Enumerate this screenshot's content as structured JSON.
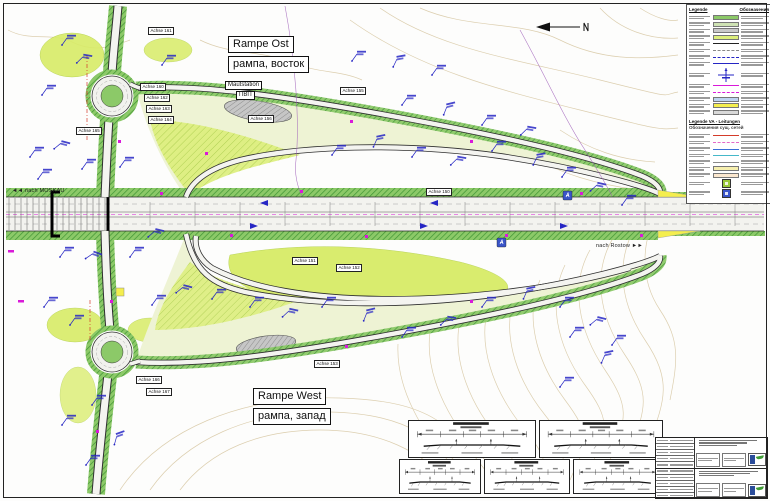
{
  "plan": {
    "rampe_ost_de": "Rampe Ost",
    "rampe_ost_ru": "рампа, восток",
    "rampe_west_de": "Rampe West",
    "rampe_west_ru": "рампа, запад",
    "mautstation_de": "Mautstation",
    "mautstation_ru": "ПВП",
    "nach_moskau": "◄◄ nach MOSKAU",
    "nach_rostow": "nach Rostow ►►"
  },
  "axes": [
    {
      "label": "Achse 161",
      "x": 148,
      "y": 27
    },
    {
      "label": "Achse 160",
      "x": 140,
      "y": 83
    },
    {
      "label": "Achse 162",
      "x": 144,
      "y": 94
    },
    {
      "label": "Achse 163",
      "x": 146,
      "y": 105
    },
    {
      "label": "Achse 164",
      "x": 148,
      "y": 116
    },
    {
      "label": "Achse 165",
      "x": 76,
      "y": 127
    },
    {
      "label": "Achse 156",
      "x": 248,
      "y": 115
    },
    {
      "label": "Achse 155",
      "x": 340,
      "y": 87
    },
    {
      "label": "Achse 150",
      "x": 426,
      "y": 188
    },
    {
      "label": "Achse 151",
      "x": 292,
      "y": 257
    },
    {
      "label": "Achse 152",
      "x": 336,
      "y": 264
    },
    {
      "label": "Achse 153",
      "x": 314,
      "y": 360
    },
    {
      "label": "Achse 166",
      "x": 136,
      "y": 376
    },
    {
      "label": "Achse 167",
      "x": 146,
      "y": 388
    }
  ],
  "legend": {
    "header_de": "Legende",
    "header_ru": "Обозначения",
    "section2_de": "Legende VA - Leitungen",
    "section2_ru": "Обозначения сущ. сетей",
    "section1_samples": [
      {
        "kind": "chip",
        "color": "#8cc968",
        "hatch": true
      },
      {
        "kind": "chip",
        "color": "#cfe3b4",
        "hatch": true
      },
      {
        "kind": "chip",
        "color": "#c9c9c9",
        "hatch": false
      },
      {
        "kind": "chip",
        "color": "#dcee7a",
        "hatch": true
      },
      {
        "kind": "line",
        "color": "#222222",
        "style": "solid"
      },
      {
        "kind": "line",
        "color": "#888888",
        "style": "dashed"
      },
      {
        "kind": "line",
        "color": "#2626c4",
        "style": "dashed"
      },
      {
        "kind": "line",
        "color": "#2626c4",
        "style": "solid"
      },
      {
        "kind": "glyph",
        "color": "#2626c4"
      },
      {
        "kind": "line",
        "color": "#d91ad9",
        "style": "solid"
      },
      {
        "kind": "line",
        "color": "#d91ad9",
        "style": "dashed"
      },
      {
        "kind": "chip",
        "color": "#bcd4f0",
        "hatch": false
      },
      {
        "kind": "chip",
        "color": "#f4ee4e",
        "hatch": false
      },
      {
        "kind": "chip",
        "color": "#d9d9d9",
        "hatch": false
      }
    ],
    "section2_samples": [
      {
        "kind": "line",
        "color": "#d43b2a",
        "style": "solid"
      },
      {
        "kind": "line",
        "color": "#e469c8",
        "style": "dashed"
      },
      {
        "kind": "line",
        "color": "#3a6fd8",
        "style": "solid"
      },
      {
        "kind": "line",
        "color": "#45b8c9",
        "style": "solid"
      },
      {
        "kind": "line",
        "color": "#8a8a8a",
        "style": "solid"
      },
      {
        "kind": "chip",
        "color": "#f6efae",
        "hatch": false
      },
      {
        "kind": "chip",
        "color": "#fce8cf",
        "hatch": false
      }
    ],
    "icon_samples": [
      {
        "kind": "icon",
        "color": "#9ac93a"
      },
      {
        "kind": "icon",
        "color": "#3a55c9"
      }
    ]
  },
  "colors": {
    "contour": "#d9caa7",
    "verge_green": "#8cc968",
    "lime": "#d8ec67",
    "annotation_blue": "#2626c4",
    "magenta": "#d91ad9",
    "toll_gray": "#b7b7b7"
  }
}
